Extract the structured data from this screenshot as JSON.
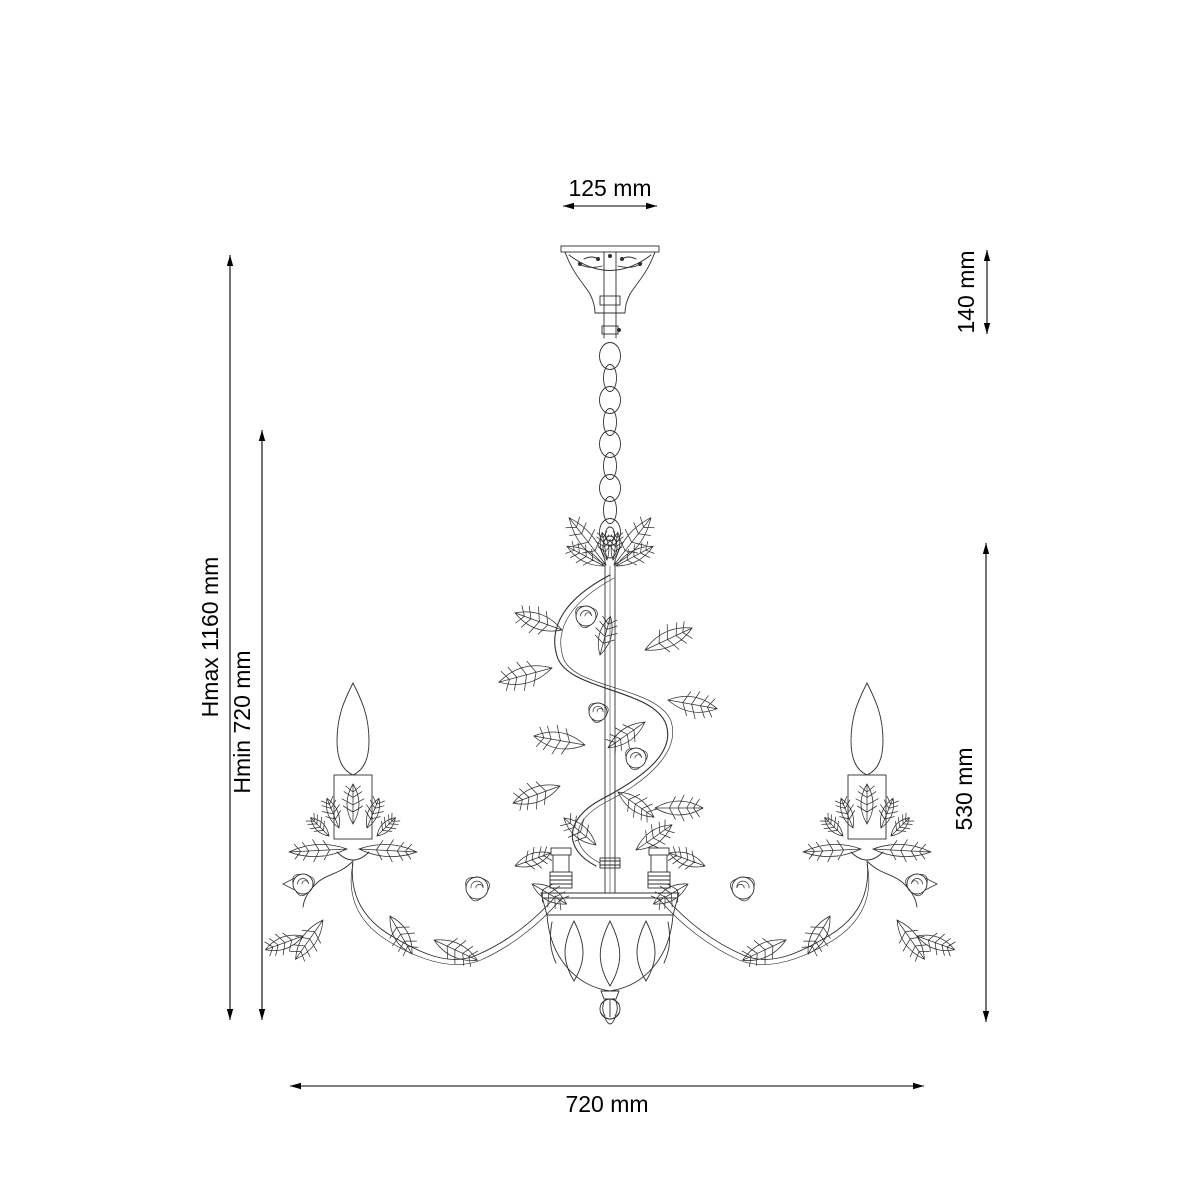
{
  "page": {
    "background": "#ffffff"
  },
  "diagram": {
    "type": "technical dimension drawing",
    "subject": "floral chandelier, front elevation line drawing",
    "stroke_color": "#2f2f2f",
    "dimension_color": "#000000",
    "dimensions": {
      "canopy_width": {
        "label": "125 mm",
        "value_mm": 125,
        "orientation": "horizontal",
        "position": "top"
      },
      "canopy_height": {
        "label": "140 mm",
        "value_mm": 140,
        "orientation": "vertical",
        "position": "top-right"
      },
      "height_max": {
        "label": "Hmax 1160 mm",
        "value_mm": 1160,
        "orientation": "vertical",
        "position": "left-outer"
      },
      "height_min": {
        "label": "Hmin 720 mm",
        "value_mm": 720,
        "orientation": "vertical",
        "position": "left-inner"
      },
      "body_height": {
        "label": "530 mm",
        "value_mm": 530,
        "orientation": "vertical",
        "position": "right"
      },
      "body_width": {
        "label": "720 mm",
        "value_mm": 720,
        "orientation": "horizontal",
        "position": "bottom"
      }
    }
  }
}
